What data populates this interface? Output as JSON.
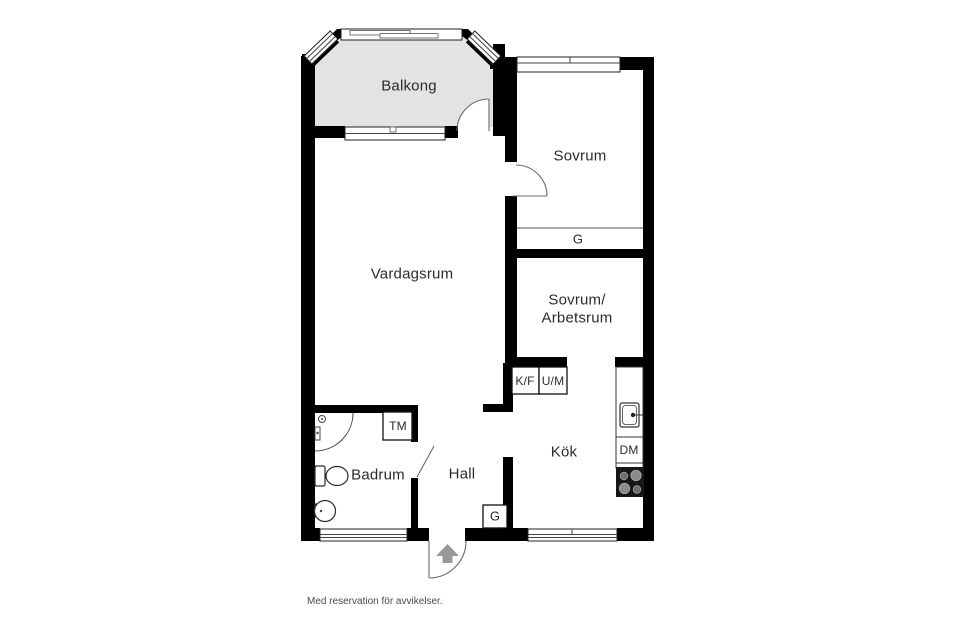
{
  "plan": {
    "rooms": {
      "balkong": "Balkong",
      "sovrum": "Sovrum",
      "vardagsrum": "Vardagsrum",
      "sovrum_arbetsrum_line1": "Sovrum/",
      "sovrum_arbetsrum_line2": "Arbetsrum",
      "kok": "Kök",
      "hall": "Hall",
      "badrum": "Badrum"
    },
    "fixtures": {
      "wardrobe_top": "G",
      "wardrobe_hall": "G",
      "fridge_freezer": "K/F",
      "oven_microwave": "U/M",
      "washing_machine": "TM",
      "dishwasher": "DM"
    },
    "icons": {
      "entry_arrow": "up-arrow-entrance",
      "stove": "four-burner-stove",
      "kitchen_sink": "sink-basin-with-tap",
      "shower": "corner-shower-with-handset",
      "toilet": "toilet-with-cistern",
      "bathroom_sink": "round-basin"
    },
    "colors": {
      "wall": "#000000",
      "balcony_fill": "#e3e3e3",
      "arrow": "#999999"
    }
  },
  "footer": {
    "disclaimer": "Med reservation för avvikelser."
  }
}
